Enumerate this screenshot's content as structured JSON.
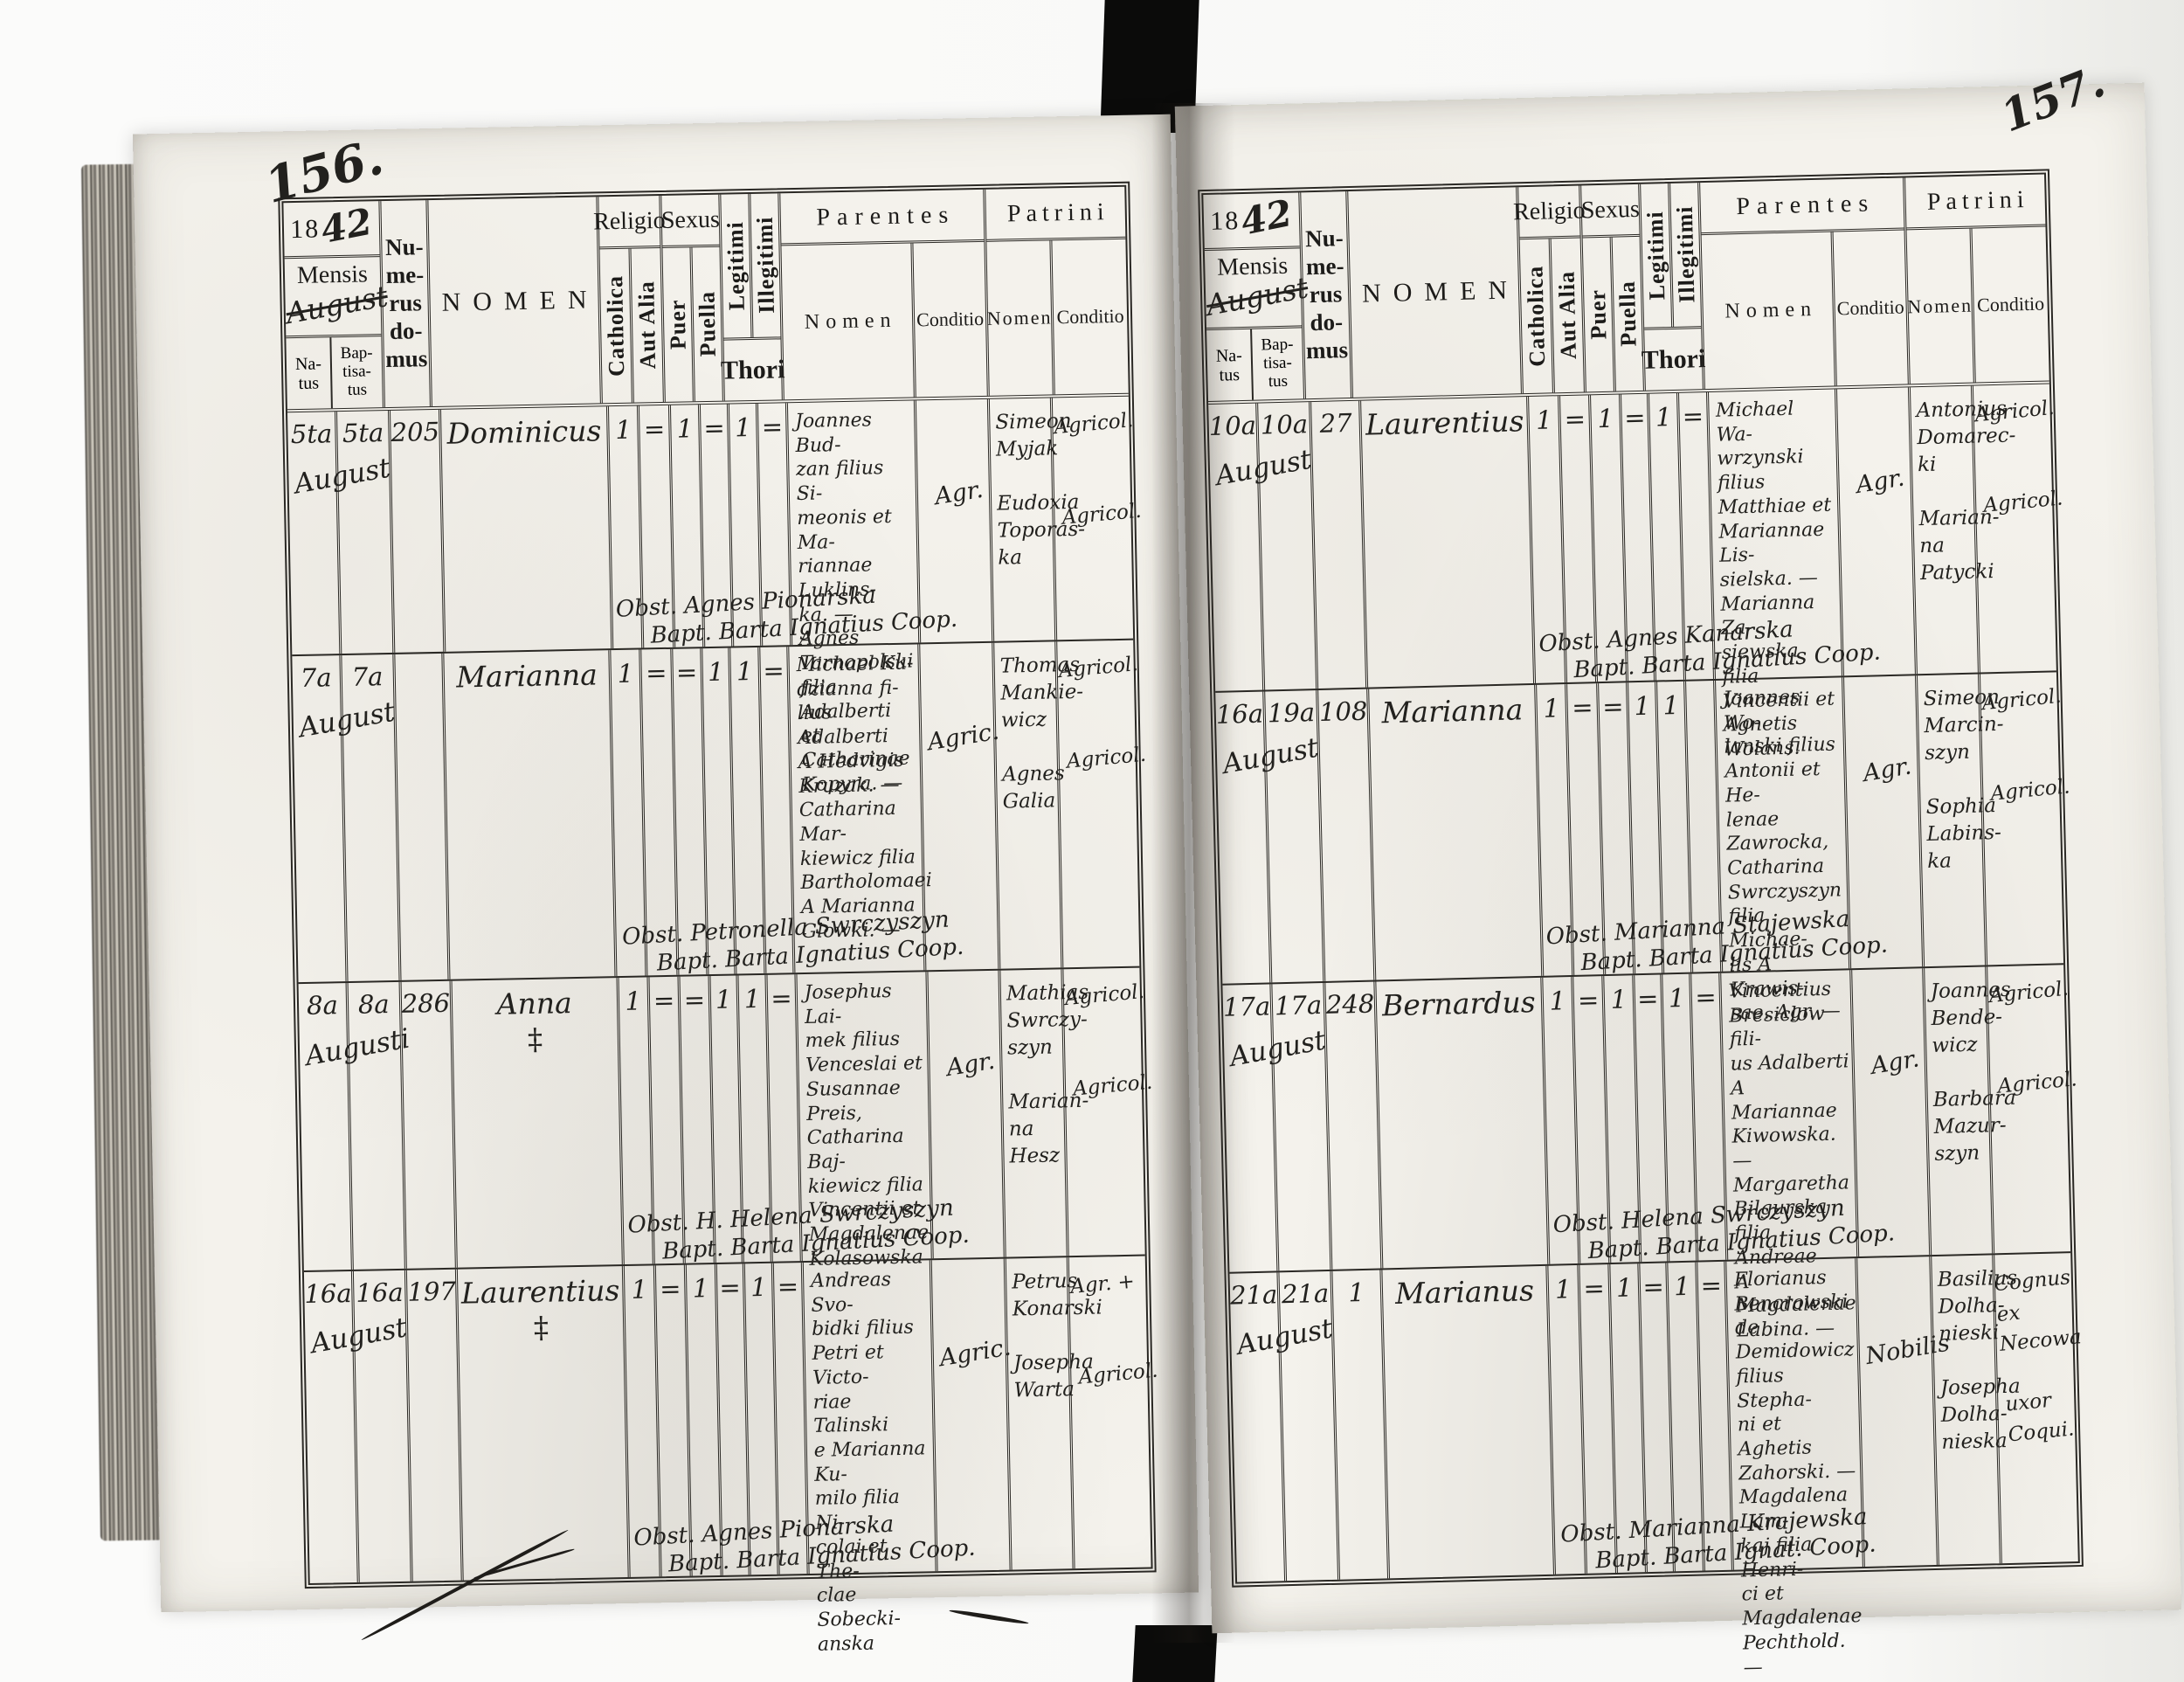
{
  "header_labels": {
    "year_print": "18",
    "year_hand": "42",
    "mensis": "Mensis",
    "mensis_hand": "August",
    "natus": "Na-\ntus",
    "baptisatus": "Bap-\ntisa-\ntus",
    "numerus_domus": "Nu-\nme-\nrus\ndo-\nmus",
    "nomen": "NOMEN",
    "religio": "Religio",
    "catholica": "Catholica",
    "aut_alia": "Aut Alia",
    "sexus": "Sexus",
    "puer": "Puer",
    "puella": "Puella",
    "legitimi": "Legitimi",
    "illegitimi": "Illegitimi",
    "thori": "Thori",
    "parentes": "Parentes",
    "patrini": "Patrini",
    "sub_nomen": "Nomen",
    "conditio": "Conditio"
  },
  "left_page": {
    "page_number": "156.",
    "rows": [
      {
        "natus": "5ta",
        "baptisatus": "5ta",
        "numerus_domus": "205",
        "mensis": "August",
        "nomen": "Dominicus",
        "nomen_note": "",
        "catholica": "1",
        "aut_alia": "=",
        "puer": "1",
        "puella": "=",
        "legitimi": "1",
        "illegitimi": "=",
        "parentes_nomen": "Joannes Bud-\nzan filius Si-\nmeonis et Ma-\nriannae Luklins-\nka. — Agnes\nTarnopolski\nfilia Adalberti\net Catharinae\nKopyra. —",
        "parentes_conditio": "Agr.",
        "patrini_nomen": "Simeon\nMyjak\n\nEudoxia\nToporas-\nka",
        "patrini_conditio": "Agricol.\n\n\nAgricol.",
        "obstetrix": "Obst. Agnes Pionarska",
        "baptizans": "Bapt. Barta Ignatius Coop."
      },
      {
        "natus": "7a",
        "baptisatus": "7a",
        "numerus_domus": "",
        "mensis": "August",
        "nomen": "Marianna",
        "nomen_note": "",
        "catholica": "1",
        "aut_alia": "=",
        "puer": "=",
        "puella": "1",
        "legitimi": "1",
        "illegitimi": "=",
        "parentes_nomen": "Michael Ku-\ndzianna fi-\nlius Adalberti\nA Hedvigis\nKruzak. —\nCatharina Mar-\nkiewicz filia\nBartholomaei\nA Marianna\nGlowki. —",
        "parentes_conditio": "Agric.",
        "patrini_nomen": "Thomas\nMankie-\nwicz\n\nAgnes\nGalia",
        "patrini_conditio": "Agricol.\n\n\nAgricol.",
        "obstetrix": "Obst. Petronella Swrczyszyn",
        "baptizans": "Bapt. Barta Ignatius Coop."
      },
      {
        "natus": "8a",
        "baptisatus": "8a",
        "numerus_domus": "286",
        "mensis": "Augusti",
        "nomen": "Anna",
        "nomen_note": "‡",
        "catholica": "1",
        "aut_alia": "=",
        "puer": "=",
        "puella": "1",
        "legitimi": "1",
        "illegitimi": "=",
        "parentes_nomen": "Josephus Lai-\nmek filius\nVenceslai et\nSusannae Preis,\nCatharina Baj-\nkiewicz filia\nVincentii et\nMagdalenae\nKolasowska",
        "parentes_conditio": "Agr.",
        "patrini_nomen": "Mathias\nSwrczy-\nszyn\n\nMarian-\nna Hesz",
        "patrini_conditio": "Agricol.\n\n\nAgricol.",
        "obstetrix": "Obst. H. Helena Swrczyszyn",
        "baptizans": "Bapt. Barta Ignatius Coop."
      },
      {
        "natus": "16a",
        "baptisatus": "16a",
        "numerus_domus": "197",
        "mensis": "August",
        "nomen": "Laurentius",
        "nomen_note": "‡",
        "catholica": "1",
        "aut_alia": "=",
        "puer": "1",
        "puella": "=",
        "legitimi": "1",
        "illegitimi": "=",
        "parentes_nomen": "Andreas Svo-\nbidki filius\nPetri et Victo-\nriae Talinski\ne Marianna Ku-\nmilo filia Ni-\ncolai et The-\nclae Sobecki-\nanska",
        "parentes_conditio": "Agric.",
        "patrini_nomen": "Petrus\nKonarski\n\nJosepha\nWarta",
        "patrini_conditio": "Agr. +\n\n\nAgricol.",
        "obstetrix": "Obst. Agnes Pionarska",
        "baptizans": "Bapt. Barta Ignatius Coop."
      }
    ]
  },
  "right_page": {
    "page_number": "157.",
    "rows": [
      {
        "natus": "10a",
        "baptisatus": "10a",
        "numerus_domus": "27",
        "mensis": "August",
        "nomen": "Laurentius",
        "nomen_note": "",
        "catholica": "1",
        "aut_alia": "=",
        "puer": "1",
        "puella": "=",
        "legitimi": "1",
        "illegitimi": "=",
        "parentes_nomen": "Michael Wa-\nwrzynski filius\nMatthiae et\nMariannae Lis-\nsielska. —\nMarianna Za-\nsiewska filia\nVincentii et\nAgnetis Wolans.",
        "parentes_conditio": "Agr.",
        "patrini_nomen": "Antonius\nDomarec-\nki\n\nMarian-\nna\nPatycki",
        "patrini_conditio": "Agricol.\n\n\nAgricol.",
        "obstetrix": "Obst. Agnes Kanarska",
        "baptizans": "Bapt. Barta Ignatius Coop."
      },
      {
        "natus": "16a",
        "baptisatus": "19a",
        "numerus_domus": "108",
        "mensis": "August",
        "nomen": "Marianna",
        "nomen_note": "",
        "catholica": "1",
        "aut_alia": "=",
        "puer": "=",
        "puella": "1",
        "legitimi": "1",
        "illegitimi": "",
        "parentes_nomen": "Joannes Wo-\nlanski filius\nAntonii et He-\nlenae Zawrocka,\nCatharina\nSwrczyszyn\nfilia Michae-\nlis A Krawis-\nsae. Agr. —",
        "parentes_conditio": "Agr.",
        "patrini_nomen": "Simeon\nMarcin-\nszyn\n\nSophia\nLabins-\nka",
        "patrini_conditio": "Agricol.\n\n\nAgricol.",
        "obstetrix": "Obst. Marianna Stajewska",
        "baptizans": "Bapt. Barta Ignatius Coop."
      },
      {
        "natus": "17a",
        "baptisatus": "17a",
        "numerus_domus": "248",
        "mensis": "August",
        "nomen": "Bernardus",
        "nomen_note": "",
        "catholica": "1",
        "aut_alia": "=",
        "puer": "1",
        "puella": "=",
        "legitimi": "1",
        "illegitimi": "=",
        "parentes_nomen": "Vincentius\nBresiclow fili-\nus Adalberti\nA Mariannae\nKiwowska. —\nMargaretha\nBilgurska\nfilia Andreae\nA Magdalenae\nLabina. —",
        "parentes_conditio": "Agr.",
        "patrini_nomen": "Joannes\nBende-\nwicz\n\nBarbara\nMazur-\nszyn",
        "patrini_conditio": "Agricol.\n\n\nAgricol.",
        "obstetrix": "Obst. Helena Swrczyszyn",
        "baptizans": "Bapt. Barta Ignatius Coop."
      },
      {
        "natus": "21a",
        "baptisatus": "21a",
        "numerus_domus": "1",
        "mensis": "August",
        "nomen": "Marianus",
        "nomen_note": "",
        "catholica": "1",
        "aut_alia": "=",
        "puer": "1",
        "puella": "=",
        "legitimi": "1",
        "illegitimi": "=",
        "parentes_nomen": "Florianus\nBencrowski\nde Demidowicz\nfilius Stepha-\nni et Aghetis\nZahorski. —\nMagdalena Lam-\nkaj filia Henri-\nci et Magdalenae\nPechthold. —",
        "parentes_conditio": "Nobilis",
        "patrini_nomen": "Basilius\nDolha-\nnieski\n\nJosepha\nDolha-\nnieska",
        "patrini_conditio": "Cognus\nex\nNecowa\n\nuxor\nCoqui.",
        "obstetrix": "Obst. Marianna Krajewska",
        "baptizans": "Bapt. Barta Ignat. Coop."
      }
    ]
  }
}
